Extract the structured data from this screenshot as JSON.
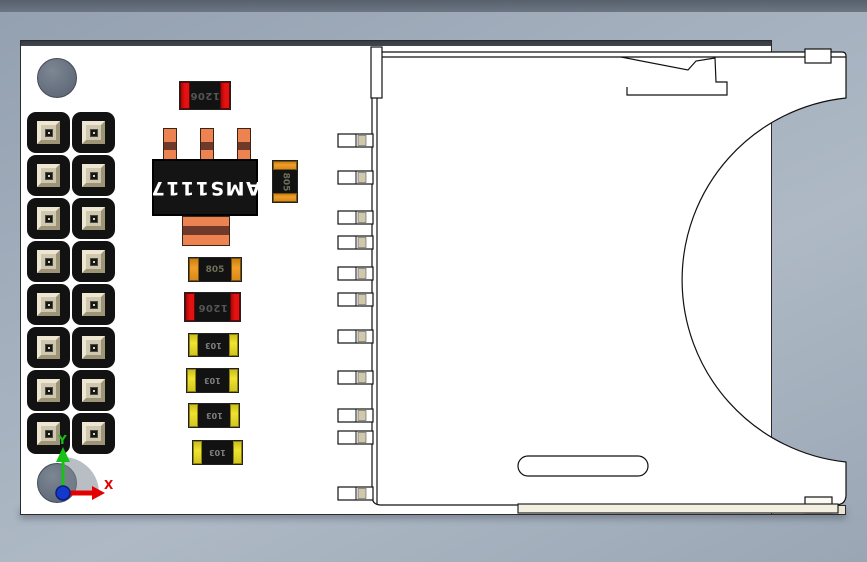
{
  "app": {
    "type": "3d-cad-viewport",
    "description": "3D model of an SD card breakout PCB viewed from above"
  },
  "colors": {
    "top_band": "#57616d",
    "pcb_white": "#ffffff",
    "pcb_edge_dark": "#41484f",
    "pcb_side_beige": "#e9e5d2",
    "component_black": "#121212",
    "red_cap": "#e31111",
    "orange_cap": "#f0a028",
    "yellow_cap": "#efe42e",
    "lead_orange": "#ee8352",
    "lead_band": "#703a2a",
    "pin_cream": "#cfc8ae",
    "axis_x_red": "#e40000",
    "axis_y_green": "#17c117",
    "axis_z_blue": "#1238cc"
  },
  "axis_triad": {
    "x_label": "X",
    "y_label": "Y"
  },
  "components": {
    "voltage_regulator": {
      "label": "AMS1117",
      "package": "SOT-223",
      "text_orientation": "rotated-180"
    },
    "fuse_top": {
      "label": "1206"
    },
    "fuse_mid": {
      "label": "1206"
    },
    "cap_vertical": {
      "label": "805"
    },
    "cap_horizontal": {
      "label": "805"
    },
    "resistors": [
      {
        "label": "103"
      },
      {
        "label": "103"
      },
      {
        "label": "103"
      },
      {
        "label": "103"
      }
    ],
    "pin_header": {
      "rows": 8,
      "cols": 2
    },
    "sd_slot": {
      "pin_count": 11
    }
  }
}
